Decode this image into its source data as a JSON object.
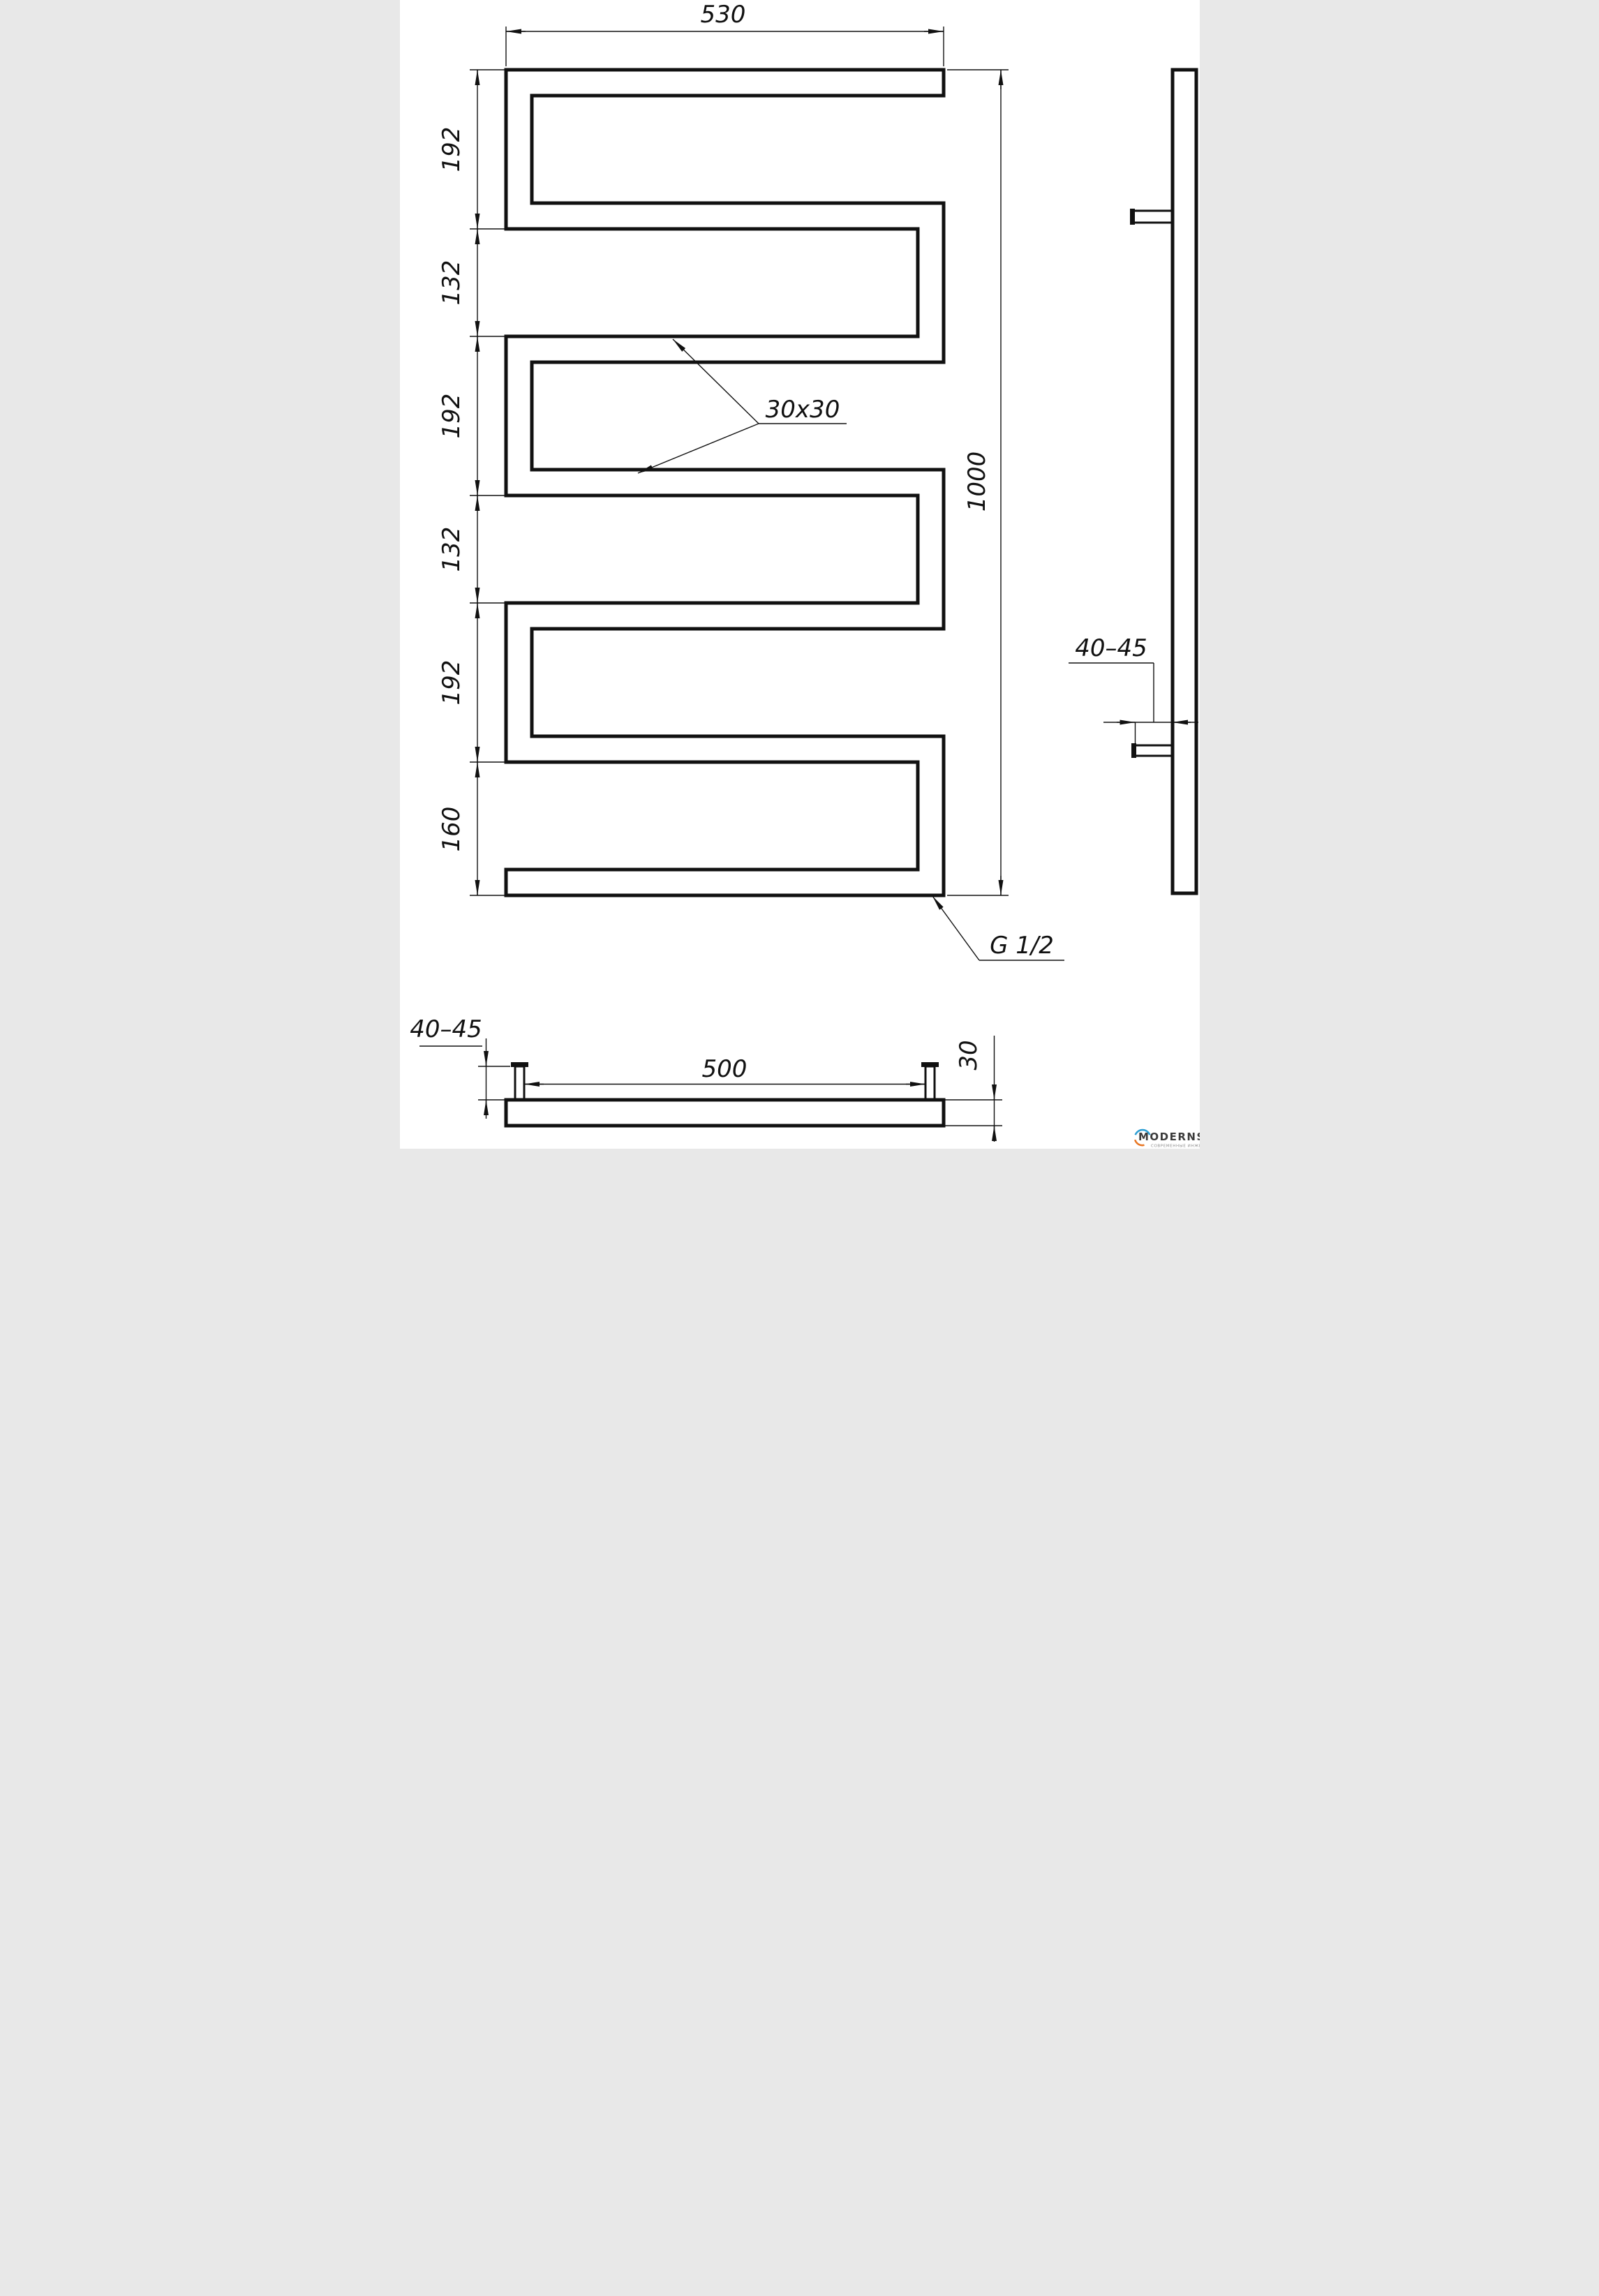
{
  "page": {
    "background": "#ffffff",
    "line_color": "#111111"
  },
  "front_view": {
    "width_dim": "530",
    "height_dim": "1000",
    "segment_dims": [
      "192",
      "132",
      "192",
      "132",
      "192",
      "160"
    ],
    "profile_note": "30x30",
    "thread_note": "G 1/2"
  },
  "side_view": {
    "wall_offset_dim": "40–45"
  },
  "bottom_view": {
    "brackets_span_dim": "500",
    "wall_offset_dim": "40–45",
    "tube_depth_dim": "30"
  },
  "logo": {
    "brand": "MODERNSYS",
    "tagline": "СОВРЕМЕННЫЕ ИНЖЕНЕРНЫЕ СИСТЕМЫ",
    "accent_blue": "#2e9fd4",
    "accent_orange": "#e87724"
  }
}
